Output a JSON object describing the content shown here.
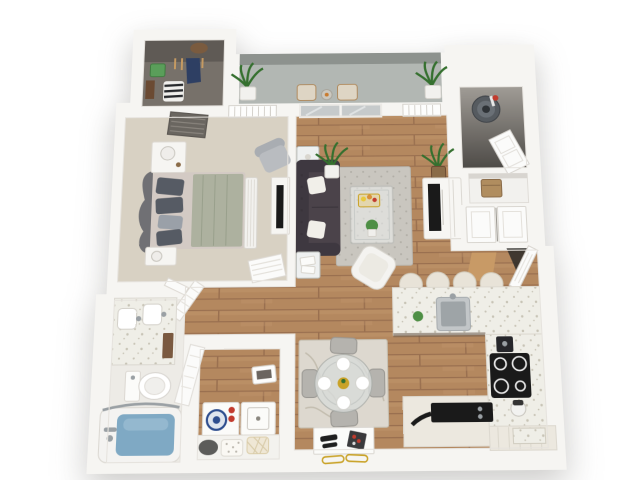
{
  "scene": {
    "type": "3d-floor-plan-render",
    "description": "Photorealistic top-down 3D floor plan of a one-bedroom, one-bathroom apartment with balcony, open living/dining/kitchen area, walk-in closet, laundry closet and utility closet",
    "background": "#ffffff"
  },
  "colors": {
    "wall": "#f6f5f2",
    "wall_edge": "#e2dfda",
    "wood": "#b4885f",
    "wood_seam": "#9a7050",
    "wood_light": "#c49a70",
    "carpet": "#d8d1c3",
    "tile": "#edebe6",
    "concrete_floor": "#b2b7b3",
    "concrete_wall": "#8d928e",
    "closet_floor": "#77716a",
    "closet_wall": "#5f5a55",
    "utility_top": "#a09c96",
    "utility_bottom": "#4e4b47",
    "rug": "#c9c6bf",
    "rug_dot": "#b1aea6",
    "dining_rug": "#ddd8cf",
    "sofa": "#4b434a",
    "sofa_dark": "#3e3840",
    "headboard": "#707074",
    "duvet": "#adb19f",
    "sheet": "#d3cac4",
    "pillow_dark": "#565b64",
    "pillow_light": "#9aa0a8",
    "water": "#7fa9c4",
    "water_light": "#a6c4d8",
    "counter": "#efeee7",
    "counter_dot": "#c8c4b6",
    "cabinet": "#ece8df",
    "appliance_black": "#1a1a1a",
    "stainless": "#9ea4a7",
    "plant_green": "#4e8f45",
    "plant_dark": "#35702f",
    "stool": "#e8e3d8",
    "chair_gray": "#b5b3ae",
    "tan_box": "#b08d5f",
    "gold": "#c9a227",
    "accent_red": "#c23b2e",
    "accent_blue": "#2d4d8e",
    "door_white": "#fbfbfa",
    "chrome": "#9aa0a4",
    "white_furniture": "#f4f3f0",
    "threshold_tan": "#c89a66",
    "glass": "#c6cacb"
  },
  "rooms": [
    {
      "id": "walk-in-closet",
      "name": "Walk-in closet",
      "position": "top-left"
    },
    {
      "id": "balcony",
      "name": "Balcony",
      "position": "top-center"
    },
    {
      "id": "utility-closet",
      "name": "Utility / water-heater closet",
      "position": "top-right"
    },
    {
      "id": "bedroom",
      "name": "Bedroom",
      "position": "left"
    },
    {
      "id": "living-room",
      "name": "Living room",
      "position": "center"
    },
    {
      "id": "entry",
      "name": "Entry",
      "position": "right"
    },
    {
      "id": "bathroom",
      "name": "Bathroom",
      "position": "bottom-left"
    },
    {
      "id": "laundry-closet",
      "name": "Laundry closet",
      "position": "bottom-center-left"
    },
    {
      "id": "dining-area",
      "name": "Dining area",
      "position": "bottom-center"
    },
    {
      "id": "kitchen",
      "name": "Kitchen",
      "position": "bottom-right"
    }
  ],
  "furniture": {
    "walk_in_closet": [
      "hangers",
      "hanging-garment",
      "green-storage-box",
      "bag",
      "striped-basket",
      "shoes"
    ],
    "balcony": [
      "potted-plant-left",
      "potted-plant-right",
      "two-patio-chairs",
      "small-table"
    ],
    "utility_closet": [
      "water-heater",
      "storage-box",
      "entry-closet-doors",
      "front-door"
    ],
    "bedroom": [
      "bed",
      "tufted-headboard",
      "pillows",
      "nightstand-with-lamp-x2",
      "armchair",
      "dresser-with-tv",
      "bench",
      "windows",
      "louvered-doors"
    ],
    "living_room": [
      "chesterfield-sofa",
      "white-throw-pillows",
      "area-rug",
      "glass-coffee-table",
      "accent-chair",
      "tv-console-with-tv",
      "floor-plants",
      "side-tables",
      "sliding-glass-door"
    ],
    "bathroom": [
      "double-sink-vanity",
      "toilet",
      "bathtub-with-water",
      "glass-screen",
      "door"
    ],
    "laundry_closet": [
      "washer",
      "dryer",
      "laundry-baskets",
      "leaning-frame",
      "door"
    ],
    "dining_area": [
      "round-glass-table",
      "four-plates",
      "gold-centerpiece",
      "four-gray-chairs",
      "marble-rug",
      "white-console",
      "decor-objects"
    ],
    "kitchen": [
      "breakfast-bar-counter",
      "four-bar-stools",
      "stainless-sink",
      "cooktop",
      "coffee-maker",
      "mixer",
      "black-griddle",
      "base-cabinets",
      "green-apple"
    ]
  }
}
